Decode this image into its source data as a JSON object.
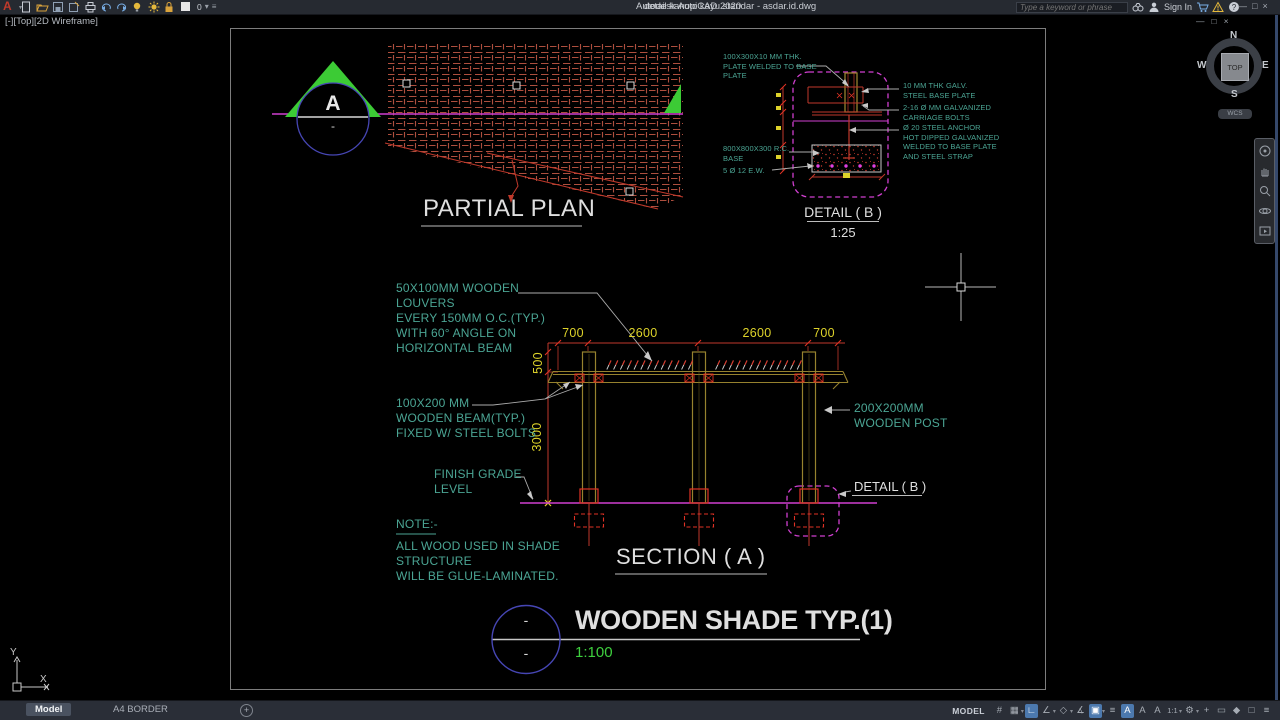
{
  "titlebar": {
    "app_name": "Autodesk AutoCAD 2020",
    "doc_name": "detail kanopi kayu standar - asdar.id.dwg",
    "search_placeholder": "Type a keyword or phrase",
    "sign_in": "Sign In",
    "layer_value": "0",
    "caret_char": "▾",
    "menu_char": "≡",
    "window_buttons": [
      "—",
      "□",
      "×"
    ],
    "qat": [
      {
        "name": "new-file-icon",
        "type": "page"
      },
      {
        "name": "open-file-icon",
        "type": "folder"
      },
      {
        "name": "save-icon",
        "type": "save"
      },
      {
        "name": "save-as-icon",
        "type": "saveas"
      },
      {
        "name": "plot-icon",
        "type": "printer"
      },
      {
        "name": "undo-icon",
        "type": "undo",
        "caret": true
      },
      {
        "name": "redo-icon",
        "type": "redo",
        "caret": true
      },
      {
        "name": "layer-bulb-icon",
        "type": "bulb"
      },
      {
        "name": "layer-sun-icon",
        "type": "sun"
      },
      {
        "name": "layer-lock-icon",
        "type": "lock"
      },
      {
        "name": "layer-color-swatch",
        "type": "swatch"
      }
    ],
    "right_icons": [
      {
        "name": "search-binoculars-icon",
        "type": "binocs"
      },
      {
        "name": "user-icon",
        "type": "user"
      }
    ],
    "right_icons2": [
      {
        "name": "cart-icon",
        "type": "cart"
      },
      {
        "name": "alert-triangle-icon",
        "type": "alert"
      },
      {
        "name": "help-icon",
        "type": "help"
      }
    ]
  },
  "canvas": {
    "viewport_label": "[-][Top][2D Wireframe]",
    "doc_window_buttons": [
      "—",
      "□",
      "×"
    ],
    "viewcube": {
      "n": "N",
      "s": "S",
      "e": "E",
      "w": "W",
      "top": "TOP",
      "wcs": "WCS"
    },
    "navbar_icons": [
      {
        "name": "navigation-wheel-icon",
        "type": "wheel"
      },
      {
        "name": "pan-icon",
        "type": "hand"
      },
      {
        "name": "zoom-icon",
        "type": "zoom"
      },
      {
        "name": "orbit-icon",
        "type": "orbit"
      },
      {
        "name": "show-motion-icon",
        "type": "motion"
      }
    ],
    "ucs": {
      "x": "X",
      "y": "Y"
    }
  },
  "drawing": {
    "partial_plan": {
      "title": "PARTIAL PLAN",
      "marker_letter": "A",
      "marker_dash": "-"
    },
    "detail_b": {
      "title": "DETAIL ( B )",
      "scale": "1:25",
      "label_plate": "100X300X10 MM THK.\nPLATE WELDED TO BASE\nPLATE",
      "label_rc_base": "800X800X300 R.C.\nBASE",
      "label_rebar": "5 Ø 12 E.W.",
      "label_base_plate": "10 MM THK GALV.\nSTEEL BASE PLATE",
      "label_bolts": "2-16 Ø MM GALVANIZED\nCARRIAGE BOLTS",
      "label_anchor": "Ø 20 STEEL ANCHOR\nHOT DIPPED GALVANIZED\nWELDED TO BASE PLATE\nAND STEEL STRAP"
    },
    "section_a": {
      "title": "SECTION ( A )",
      "dims_top": [
        "700",
        "2600",
        "2600",
        "700"
      ],
      "dims_left": [
        "500",
        "3000"
      ],
      "label_louvers": "50X100MM WOODEN\nLOUVERS\nEVERY 150MM O.C.(TYP.)\nWITH 60° ANGLE ON\nHORIZONTAL BEAM",
      "label_beam": "100X200 MM\nWOODEN BEAM(TYP.)\nFIXED W/ STEEL BOLTS",
      "label_post": "200X200MM\nWOODEN POST",
      "label_grade": "FINISH GRADE\nLEVEL",
      "label_detail_ref": "DETAIL ( B )",
      "note_title": "NOTE:-",
      "note_body": "ALL WOOD USED IN SHADE\nSTRUCTURE\nWILL BE GLUE-LAMINATED."
    },
    "main_title": {
      "text": "WOODEN SHADE TYP.(1)",
      "scale": "1:100",
      "marker_top_dash": "-",
      "marker_bottom_dash": "-"
    },
    "colors": {
      "label_green": "#4BA594",
      "dim_yellow": "#DDD22A",
      "line_red": "#C0392B",
      "bright_red": "#E03224",
      "magenta": "#CF3FCF",
      "wood_olive": "#96822E",
      "marker_blue": "#4646B4",
      "bright_green": "#3ECF3E",
      "hatch_brown": "#AE4F3E"
    }
  },
  "statusbar": {
    "tabs": [
      {
        "label": "Model",
        "active": true
      },
      {
        "label": "A4 BORDER",
        "active": false
      }
    ],
    "add_tab": "+",
    "model_button": "MODEL",
    "icons": [
      {
        "glyph": "#",
        "name": "grid-icon"
      },
      {
        "glyph": "▦",
        "caret": true,
        "name": "snap-icon"
      },
      {
        "glyph": "∟",
        "active": true,
        "name": "ortho-icon"
      },
      {
        "glyph": "∠",
        "caret": true,
        "name": "polar-tracking-icon"
      },
      {
        "glyph": "◇",
        "caret": true,
        "name": "isodraft-icon"
      },
      {
        "glyph": "∡",
        "name": "object-snap-tracking-icon"
      },
      {
        "glyph": "▣",
        "caret": true,
        "active": true,
        "name": "object-snap-icon"
      },
      {
        "glyph": "≡",
        "name": "lineweight-icon"
      },
      {
        "glyph": "A",
        "active": true,
        "name": "annotation-visibility-icon"
      },
      {
        "glyph": "A",
        "name": "annotation-autoscale-icon"
      },
      {
        "glyph": "A",
        "name": "annotation-monitor-icon"
      },
      {
        "glyph": "1:1",
        "caret": true,
        "name": "annotation-scale-button"
      },
      {
        "glyph": "⚙",
        "caret": true,
        "name": "workspace-gear-icon"
      },
      {
        "glyph": "+",
        "name": "customization-icon"
      },
      {
        "glyph": "▭",
        "name": "isolate-objects-icon"
      },
      {
        "glyph": "◆",
        "name": "graphics-performance-icon"
      },
      {
        "glyph": "□",
        "name": "clean-screen-icon"
      },
      {
        "glyph": "≡",
        "name": "hamburger-menu-icon"
      }
    ]
  }
}
